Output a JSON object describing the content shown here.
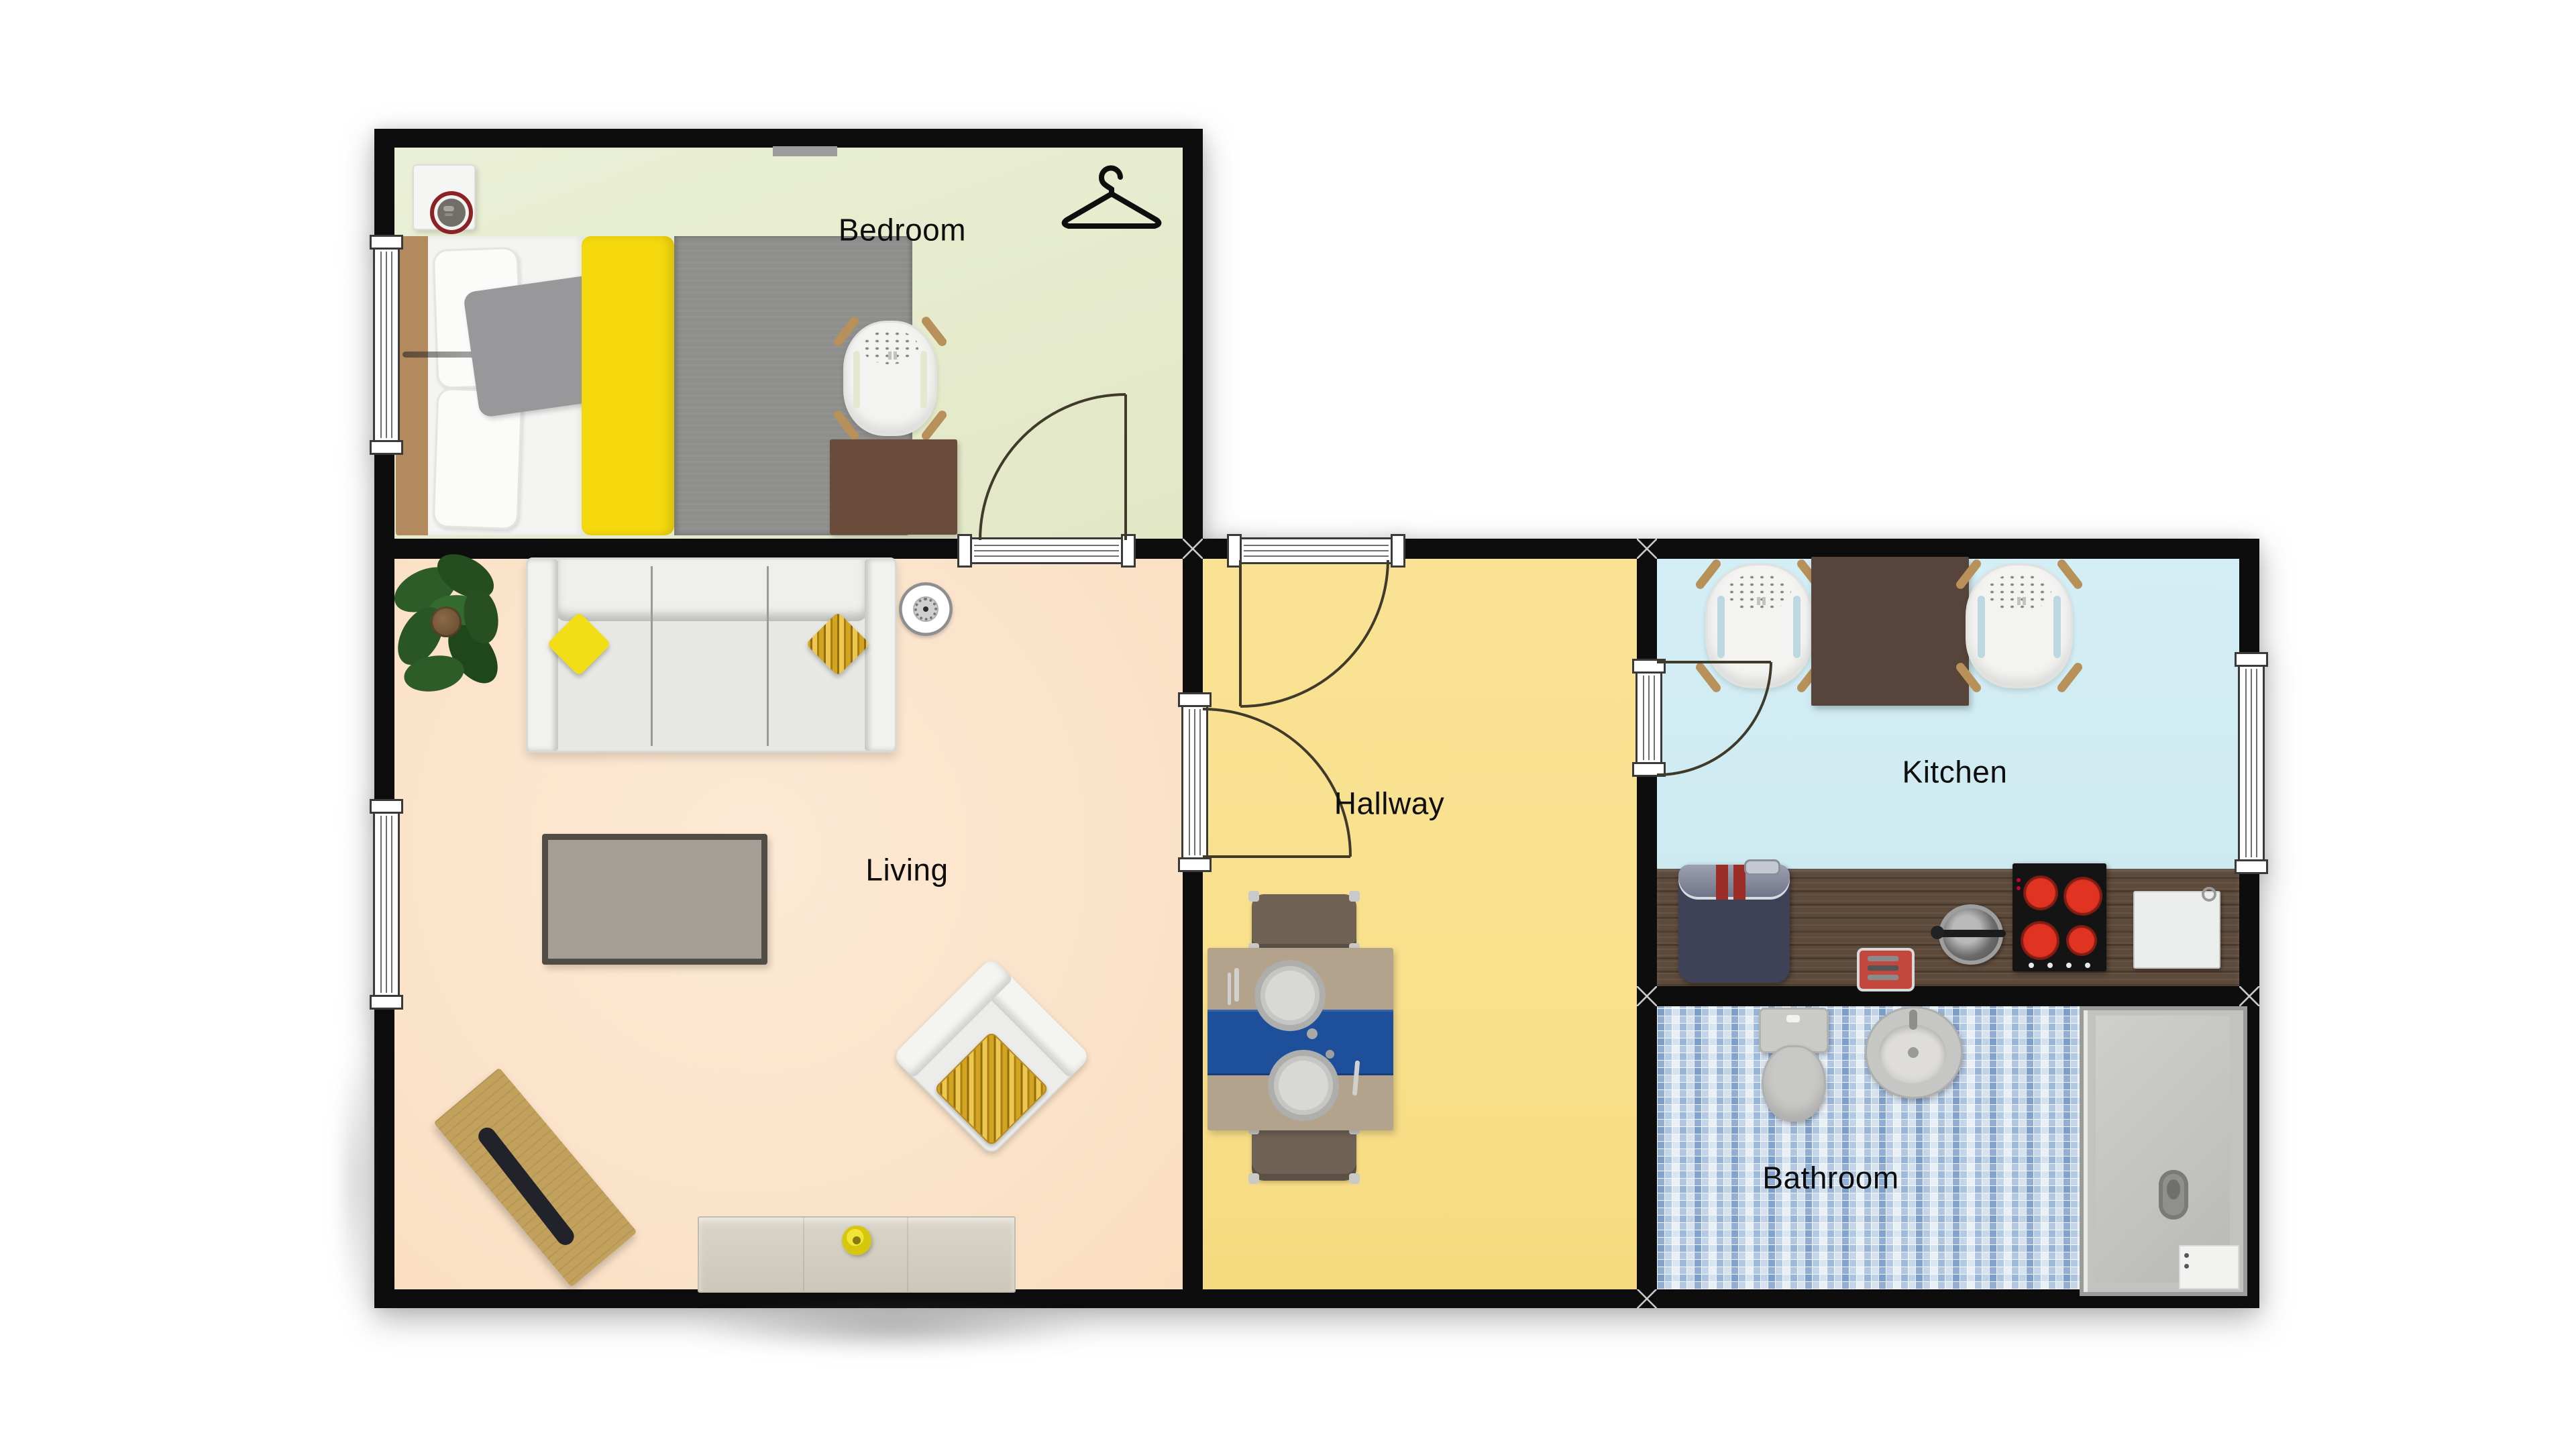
{
  "rooms": {
    "bedroom": {
      "label": "Bedroom"
    },
    "living": {
      "label": "Living"
    },
    "hallway": {
      "label": "Hallway"
    },
    "kitchen": {
      "label": "Kitchen"
    },
    "bathroom": {
      "label": "Bathroom"
    }
  },
  "icons": {
    "hanger": "clothes-hanger-icon",
    "robot_vacuum": "robot-vacuum-dock-icon",
    "ceiling_light": "ceiling-light-icon"
  },
  "palette": {
    "wall": "#0d0d0d",
    "bedroom_floor": "#e6ebcd",
    "living_floor": "#fbe3ca",
    "hallway_floor": "#f8e08c",
    "kitchen_floor": "#cfecf2",
    "bathroom_tile_blue": "#5b8fc9",
    "accent_yellow": "#f3de17",
    "bed_duvet_gray": "#8e8e8c",
    "counter_wood": "#5d4a3b",
    "dining_table_wood": "#b3a28c",
    "table_runner_blue": "#1e4f9b",
    "fridge_navy": "#3f4257",
    "stove_burner_red": "#d03020"
  }
}
